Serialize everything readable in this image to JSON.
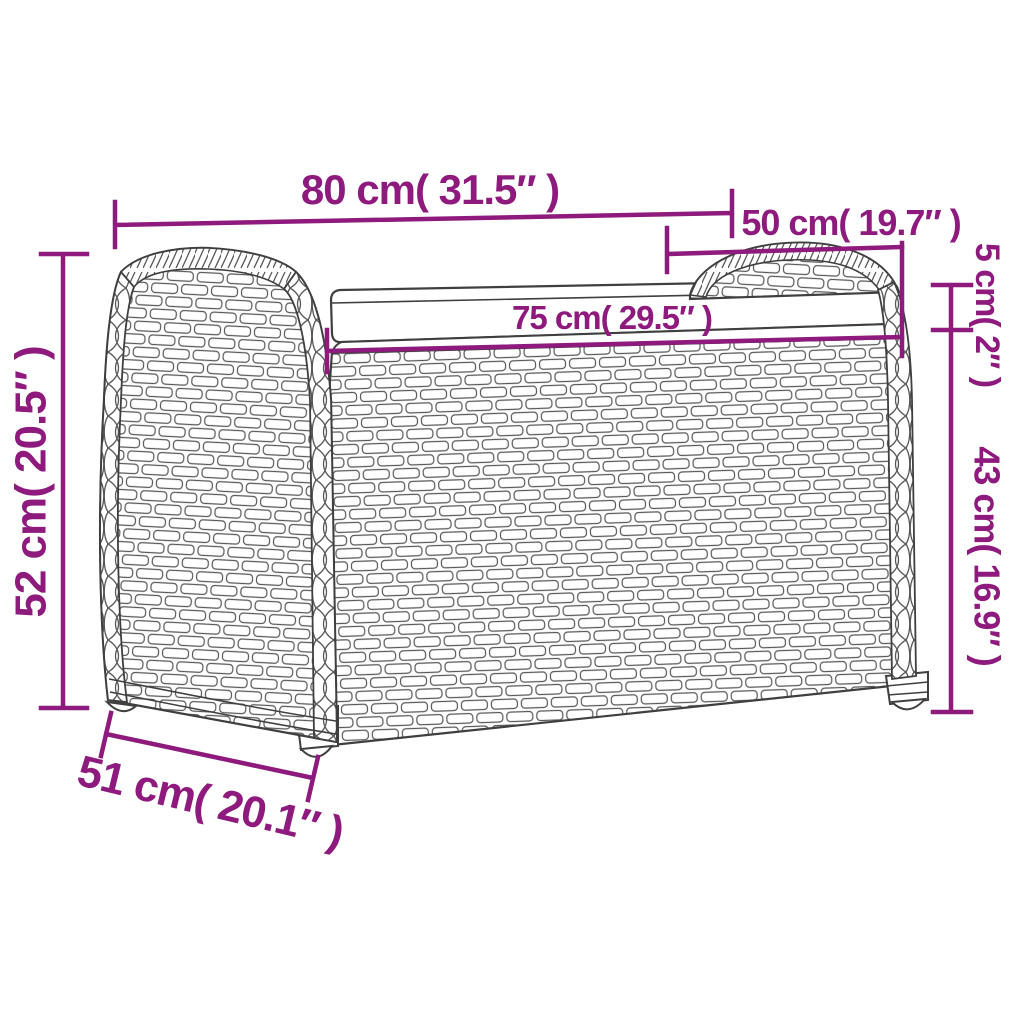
{
  "palette": {
    "dimension_color": "#8E1A7D",
    "outline_color": "#3F3F3F",
    "weave_line_color": "#575757",
    "background": "#FFFFFF"
  },
  "figure": {
    "name": "rattan-storage-bench-line-drawing",
    "parts": [
      "left-armrest",
      "right-armrest",
      "seat-cushion",
      "storage-box-front",
      "feet"
    ]
  },
  "diagram": {
    "dimensions": {
      "top_width": {
        "label": "80 cm( 31.5″ )"
      },
      "arm_depth": {
        "label": "50 cm( 19.7″ )"
      },
      "seat_width": {
        "label": "75 cm( 29.5″ )"
      },
      "cushion_height": {
        "label": "5 cm( 2″ )"
      },
      "box_height": {
        "label": "43 cm( 16.9″ )"
      },
      "total_height": {
        "label": "52 cm( 20.5″ )"
      },
      "base_depth": {
        "label": "51 cm( 20.1″ )"
      }
    }
  }
}
